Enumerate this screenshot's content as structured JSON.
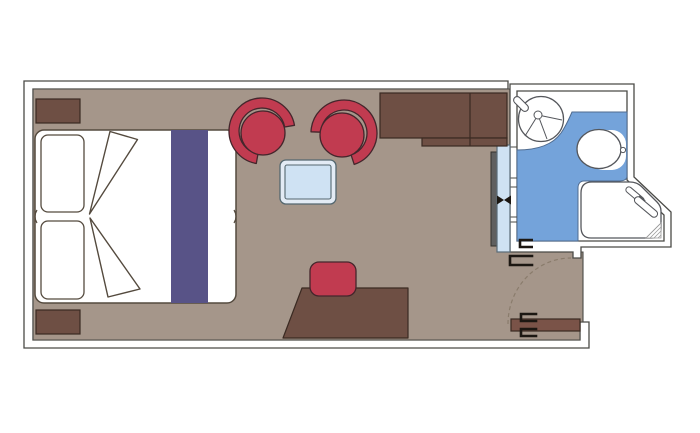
{
  "plan": {
    "kind": "cruise-cabin-floorplan",
    "rooms": [
      "stateroom",
      "bathroom",
      "entry-vestibule"
    ],
    "furniture": [
      "double-bed",
      "pillow",
      "bed-runner",
      "folded-duvet",
      "nightstand",
      "vanity-cabinet",
      "armchair",
      "coffee-table",
      "stool",
      "desk",
      "wardrobe-mirror-slider",
      "washbasin",
      "toilet",
      "shower",
      "entry-door"
    ]
  },
  "colors": {
    "background": "#ffffff",
    "wall_fill": "#ffffff",
    "outline": "#4a4a46",
    "floor": "#a5968a",
    "wood_dark": "#6e4f44",
    "entry_door": "#7a5348",
    "bed_fill": "#ffffff",
    "bed_outline": "#544a3e",
    "runner": "#585387",
    "chair_red": "#c13b50",
    "chair_outline": "#44262c",
    "table_frame": "#e3ebf5",
    "table_top": "#cfe2f3",
    "bath_floor": "#74a3da",
    "bath_floor_edge": "#4f6b8f",
    "fixture_fill": "#ffffff",
    "fixture_outline": "#55575c",
    "glass_panel": "#cfe2f3",
    "slider_gray": "#5f5f5f",
    "hinge_black": "#1c1712",
    "swing_dash": "#8a7c6c",
    "hatch_gray": "#9a9a9a"
  }
}
